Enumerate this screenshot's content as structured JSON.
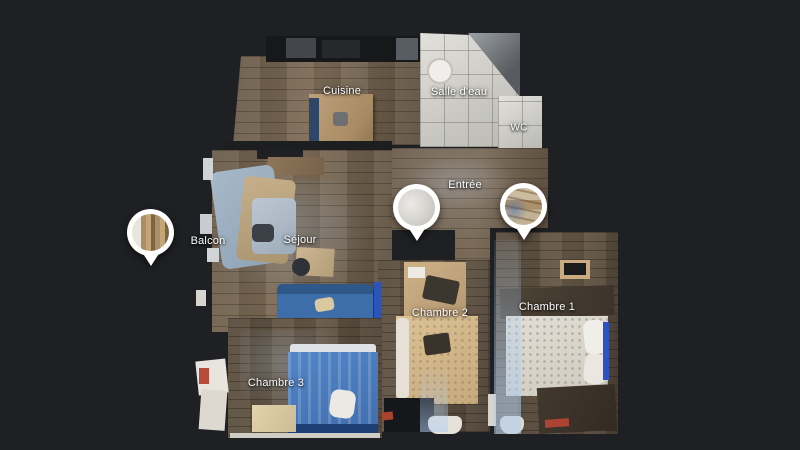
{
  "view": {
    "name": "3D dollhouse floor plan of apartment",
    "background_color": "#1e2023",
    "label_color": "#ffffff"
  },
  "rooms": [
    {
      "id": "cuisine",
      "label": "Cuisine"
    },
    {
      "id": "salle-deau",
      "label": "Salle d'eau"
    },
    {
      "id": "wc",
      "label": "WC"
    },
    {
      "id": "entree",
      "label": "Entrée"
    },
    {
      "id": "balcon",
      "label": "Balcon"
    },
    {
      "id": "sejour",
      "label": "Séjour"
    },
    {
      "id": "chambre-2",
      "label": "Chambre 2"
    },
    {
      "id": "chambre-1",
      "label": "Chambre 1"
    },
    {
      "id": "chambre-3",
      "label": "Chambre 3"
    }
  ],
  "pins": [
    {
      "id": "pin-balcon",
      "preview": "curtains-window-photo"
    },
    {
      "id": "pin-entree-left",
      "preview": "white-wall-photo"
    },
    {
      "id": "pin-entree-right",
      "preview": "wood-shelving-photo"
    }
  ],
  "colors": {
    "pin_ring": "#ffffff",
    "wood_floor": "#6e5f4e",
    "tile_floor": "#d2d1cc",
    "sofa_blue": "#3e6ea9",
    "bed_blue": "#4d80c2",
    "bed_tan": "#d5ba8d",
    "bed_white": "#dcd7cd",
    "counter_dark": "#17181a"
  }
}
